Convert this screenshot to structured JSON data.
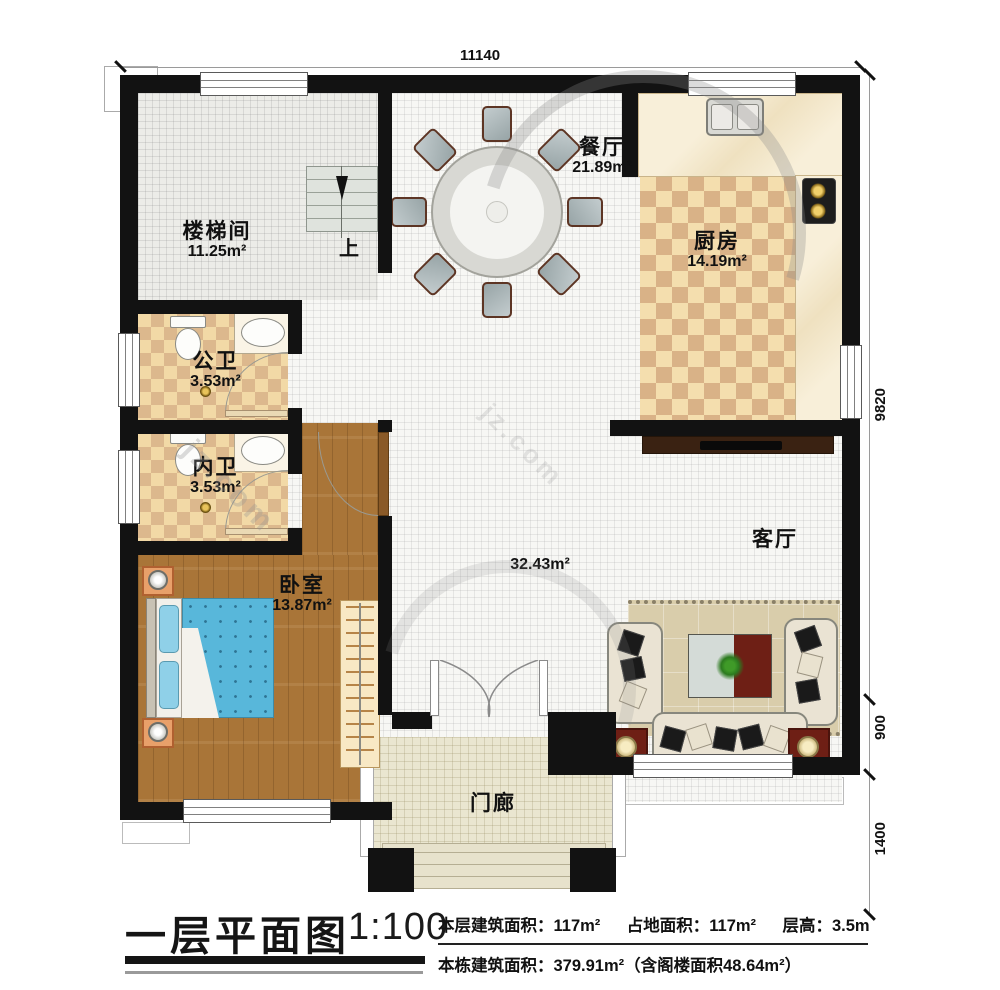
{
  "watermark": {
    "text": "jz.com"
  },
  "dimensions": {
    "top": "11140",
    "right_upper": "9820",
    "right_middle": "900",
    "right_lower": "1400"
  },
  "rooms": {
    "stair": {
      "name": "楼梯间",
      "area": "11.25m²",
      "up": "上"
    },
    "dining": {
      "name": "餐厅",
      "area": "21.89m²"
    },
    "kitchen": {
      "name": "厨房",
      "area": "14.19m²"
    },
    "public_bath": {
      "name": "公卫",
      "area": "3.53m²"
    },
    "inner_bath": {
      "name": "内卫",
      "area": "3.53m²"
    },
    "bedroom": {
      "name": "卧室",
      "area": "13.87m²"
    },
    "living": {
      "name": "客厅",
      "area": "32.43m²"
    },
    "porch": {
      "name": "门廊"
    }
  },
  "titleblock": {
    "title": "一层平面图",
    "scale": "1:100",
    "line1": [
      "本层建筑面积：117m²",
      "占地面积：117m²",
      "层高：3.5m"
    ],
    "line2": "本栋建筑面积：379.91m²（含阁楼面积48.64m²）"
  },
  "palette": {
    "wall": "#121212",
    "wood_floor": "#a97538",
    "checker_light": "#f4deae",
    "checker_dark": "#d9b287",
    "bed_blue": "#58b7da",
    "accent_red": "#6e1f15"
  }
}
